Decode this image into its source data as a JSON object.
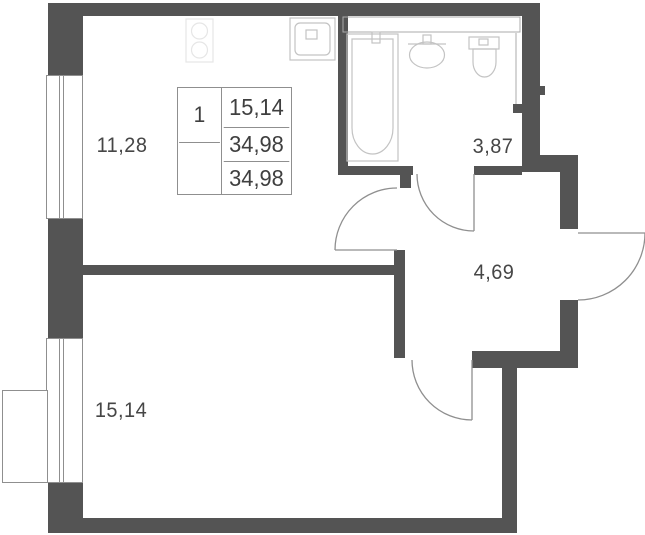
{
  "colors": {
    "wall": "#545454",
    "line": "#8f8f8f",
    "fixture": "#c3c3c3",
    "faint": "#e6e6e6",
    "text": "#464646",
    "bg": "#ffffff"
  },
  "rooms": {
    "living": {
      "label": "11,28"
    },
    "bathroom": {
      "label": "3,87"
    },
    "hall": {
      "label": "4,69"
    },
    "bedroom": {
      "label": "15,14"
    }
  },
  "area_table": {
    "rooms_count": "1",
    "living_area": "15,14",
    "total_area": "34,98",
    "overall_area": "34,98"
  },
  "icons": {
    "bathtub": "bathtub-icon",
    "bathroom_sink": "sink-icon",
    "toilet": "toilet-icon",
    "kitchen_sink": "kitchen-sink-icon",
    "stove": "stove-icon",
    "windows": "window-glyph",
    "doors": "door-swing-arc"
  }
}
